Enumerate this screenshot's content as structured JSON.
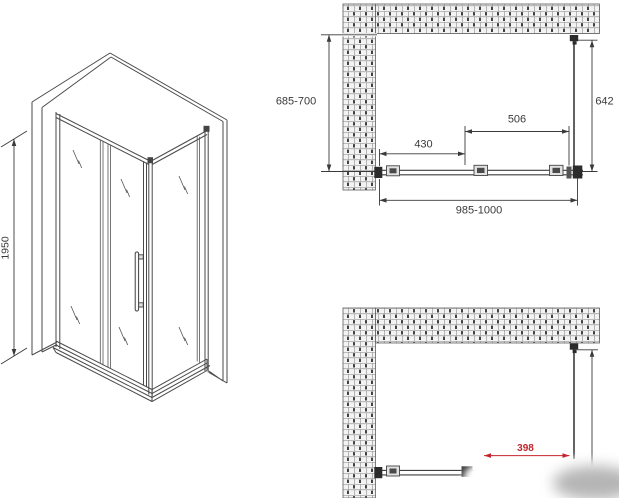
{
  "views": {
    "isometric": {
      "height_label": "1950"
    },
    "plan_top": {
      "depth_label": "685-700",
      "glass_depth_label": "642",
      "door_width_label": "430",
      "opening_width_label": "506",
      "total_width_label": "985-1000"
    },
    "plan_bottom": {
      "opening_label": "398"
    }
  },
  "colors": {
    "line": "#3a3a3a",
    "accent_red": "#c4242b",
    "brick_fill": "#f3f3f3",
    "brick_mortar": "#9a9a9a",
    "bracket_dark": "#2b2b2b",
    "background": "#ffffff"
  }
}
